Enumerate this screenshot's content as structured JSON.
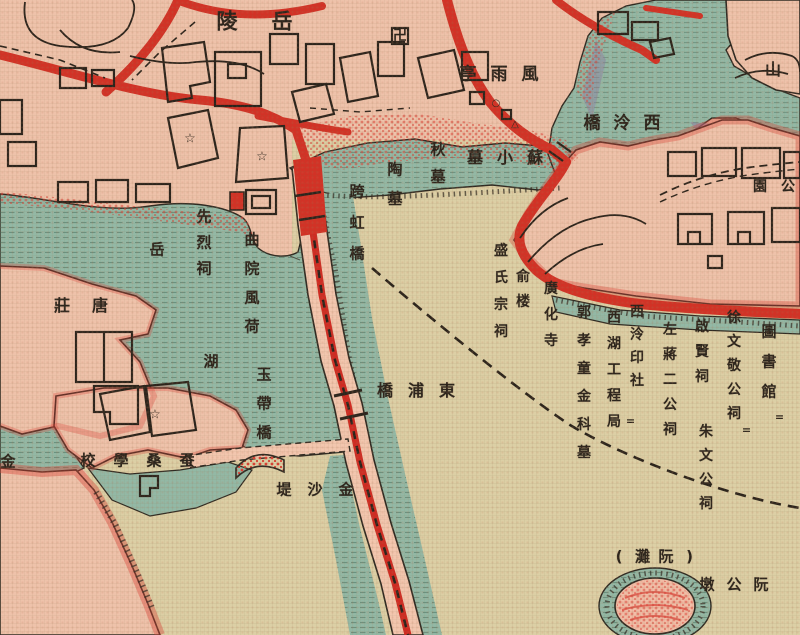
{
  "map": {
    "description_labels_note": "vintage West Lake map section; labels read right-to-left or top-to-bottom",
    "palette": {
      "land_pink": "#eec2aa",
      "lake_tan": "#dccfa5",
      "water_teal": "#93b8a5",
      "road_red": "#d23226",
      "ink_black": "#2b241c",
      "stipple_red": "#d94034",
      "shade_purple": "#8d7fa6"
    },
    "labels": [
      {
        "id": "yue-ling",
        "reading": "岳陵",
        "display": "陵岳",
        "orient": "h",
        "x": 227,
        "y": 22,
        "gap": 55,
        "size": 21
      },
      {
        "id": "feng-yu-ting",
        "reading": "風雨亭",
        "display": "亭雨風",
        "orient": "h",
        "x": 468,
        "y": 75,
        "gap": 31,
        "size": 17
      },
      {
        "id": "xi-ling-qiao",
        "reading": "西泠橋",
        "display": "橋泠西",
        "orient": "h",
        "x": 592,
        "y": 124,
        "gap": 30,
        "size": 17
      },
      {
        "id": "shan",
        "reading": "山",
        "display": "山",
        "orient": "h",
        "x": 773,
        "y": 70,
        "gap": 30,
        "size": 16
      },
      {
        "id": "su-xiao-mu",
        "reading": "蘇小墓",
        "display": "墓小蘇",
        "orient": "h",
        "x": 475,
        "y": 158,
        "gap": 30,
        "size": 16
      },
      {
        "id": "qiu-mu",
        "reading": "秋墓",
        "display": "秋墓",
        "orient": "v",
        "x": 438,
        "y": 150,
        "gap": 27,
        "size": 15
      },
      {
        "id": "tao-mu",
        "reading": "陶墓",
        "display": "陶墓",
        "orient": "v",
        "x": 395,
        "y": 170,
        "gap": 29,
        "size": 15
      },
      {
        "id": "kua-hong-qiao",
        "reading": "跨虹橋",
        "display": "跨虹橋",
        "orient": "v",
        "x": 357,
        "y": 192,
        "gap": 31,
        "size": 15
      },
      {
        "id": "xian-lie-ci",
        "reading": "先烈祠",
        "display": "先烈祠",
        "orient": "v",
        "x": 204,
        "y": 217,
        "gap": 26,
        "size": 15
      },
      {
        "id": "qu-yuan-feng-he",
        "reading": "曲院風荷",
        "display": "曲院風荷",
        "orient": "v",
        "x": 252,
        "y": 240,
        "gap": 29,
        "size": 15
      },
      {
        "id": "yue",
        "reading": "岳",
        "display": "岳",
        "orient": "h",
        "x": 157,
        "y": 250,
        "gap": 30,
        "size": 15
      },
      {
        "id": "hu",
        "reading": "湖",
        "display": "湖",
        "orient": "h",
        "x": 211,
        "y": 362,
        "gap": 30,
        "size": 15
      },
      {
        "id": "tang-zhuang",
        "reading": "唐莊",
        "display": "莊唐",
        "orient": "h",
        "x": 62,
        "y": 306,
        "gap": 38,
        "size": 16
      },
      {
        "id": "yu-dai-qiao",
        "reading": "玉帶橋",
        "display": "玉帶橋",
        "orient": "v",
        "x": 264,
        "y": 375,
        "gap": 29,
        "size": 15
      },
      {
        "id": "dong-pu-qiao",
        "reading": "東浦橋",
        "display": "橋浦東",
        "orient": "h",
        "x": 385,
        "y": 391,
        "gap": 31,
        "size": 16
      },
      {
        "id": "jin-sha-di",
        "reading": "金沙堤",
        "display": "堤沙金",
        "orient": "h",
        "x": 284,
        "y": 490,
        "gap": 31,
        "size": 15
      },
      {
        "id": "can-sang-xue-xiao",
        "reading": "蚕桑學校",
        "display": "校學桑蚕",
        "orient": "h",
        "x": 88,
        "y": 461,
        "gap": 33,
        "size": 15
      },
      {
        "id": "jin",
        "reading": "金",
        "display": "金",
        "orient": "h",
        "x": 8,
        "y": 462,
        "gap": 30,
        "size": 15
      },
      {
        "id": "sheng-shi-zong-ci",
        "reading": "盛氏宗祠",
        "display": "盛氏宗祠",
        "orient": "v",
        "x": 501,
        "y": 251,
        "gap": 27,
        "size": 14
      },
      {
        "id": "yu-lou",
        "reading": "俞楼",
        "display": "俞楼",
        "orient": "v",
        "x": 523,
        "y": 277,
        "gap": 25,
        "size": 14
      },
      {
        "id": "guang-hua-si",
        "reading": "廣化寺",
        "display": "廣化寺",
        "orient": "v",
        "x": 551,
        "y": 289,
        "gap": 26,
        "size": 14
      },
      {
        "id": "guo-xiao-tong-jin-ke-mu",
        "reading": "郭孝童金科墓",
        "display": "郭孝童金科墓",
        "orient": "v",
        "x": 584,
        "y": 313,
        "gap": 28,
        "size": 14
      },
      {
        "id": "xi-hu-gong-cheng-ju",
        "reading": "西湖工程局",
        "display": "西湖工程局",
        "orient": "v",
        "x": 614,
        "y": 318,
        "gap": 26,
        "size": 14
      },
      {
        "id": "xi-ling-yin-she",
        "reading": "西泠印社",
        "display": "西泠印社",
        "orient": "v",
        "x": 637,
        "y": 312,
        "gap": 23,
        "size": 14
      },
      {
        "id": "zuo-jiang-er-gong-ci",
        "reading": "左蔣二公祠",
        "display": "左蔣二公祠",
        "orient": "v",
        "x": 670,
        "y": 330,
        "gap": 25,
        "size": 14
      },
      {
        "id": "qi-xian-ci",
        "reading": "啟賢祠",
        "display": "啟賢祠",
        "orient": "v",
        "x": 702,
        "y": 327,
        "gap": 25,
        "size": 14
      },
      {
        "id": "zhu-wen-gong-ci",
        "reading": "朱文公祠",
        "display": "朱文公祠",
        "orient": "v",
        "x": 706,
        "y": 432,
        "gap": 24,
        "size": 14
      },
      {
        "id": "xu-wen-jing-gong-ci",
        "reading": "徐文敬公祠",
        "display": "徐文敬公祠",
        "orient": "v",
        "x": 734,
        "y": 318,
        "gap": 24,
        "size": 14
      },
      {
        "id": "tu-shu-guan",
        "reading": "圖書館",
        "display": "圖書館",
        "orient": "v",
        "x": 769,
        "y": 332,
        "gap": 30,
        "size": 15
      },
      {
        "id": "gong-yuan",
        "reading": "公園",
        "display": "園公",
        "orient": "h",
        "x": 760,
        "y": 187,
        "gap": 28,
        "size": 14
      },
      {
        "id": "ruan-tan",
        "reading": "(阮灘)",
        "display": "(灘阮)",
        "orient": "h",
        "x": 619,
        "y": 557,
        "gap": 23.5,
        "size": 15
      },
      {
        "id": "ruan-gong-dun",
        "reading": "阮公墩",
        "display": "墩公阮",
        "orient": "h",
        "x": 707,
        "y": 585,
        "gap": 27,
        "size": 15
      }
    ],
    "symbols": [
      {
        "type": "star",
        "char": "☆",
        "x": 190,
        "y": 139
      },
      {
        "type": "star",
        "char": "☆",
        "x": 262,
        "y": 157
      },
      {
        "type": "star",
        "char": "☆",
        "x": 155,
        "y": 415
      },
      {
        "type": "manji",
        "char": "卍",
        "x": 400,
        "y": 36
      },
      {
        "type": "circle",
        "char": "○",
        "x": 496,
        "y": 104
      },
      {
        "type": "triangle",
        "char": "△",
        "x": 515,
        "y": 125
      },
      {
        "type": "ditto",
        "char": "=",
        "x": 779,
        "y": 417
      },
      {
        "type": "ditto",
        "char": "=",
        "x": 746,
        "y": 430
      },
      {
        "type": "ditto",
        "char": "=",
        "x": 630,
        "y": 421
      }
    ]
  }
}
